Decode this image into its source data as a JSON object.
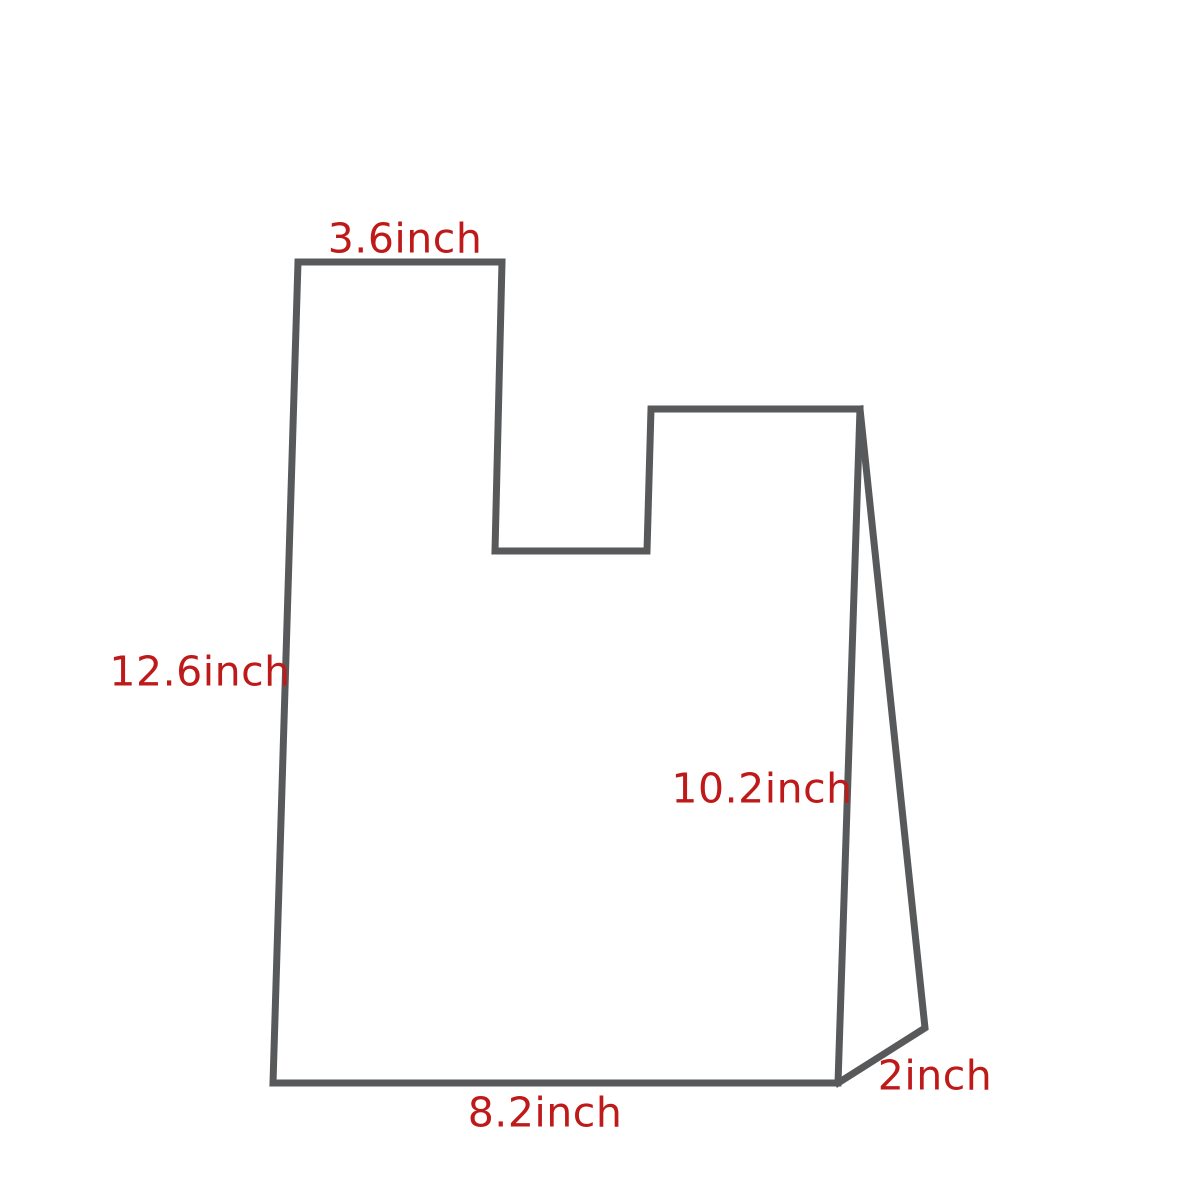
{
  "diagram": {
    "labels": {
      "handle_width": "3.6inch",
      "bag_height": "12.6inch",
      "side_height": "10.2inch",
      "gusset_depth": "2inch",
      "bag_width": "8.2inch"
    },
    "colors": {
      "outline": "#58595b",
      "label_text": "#bf1a1a",
      "background": "#ffffff"
    }
  }
}
